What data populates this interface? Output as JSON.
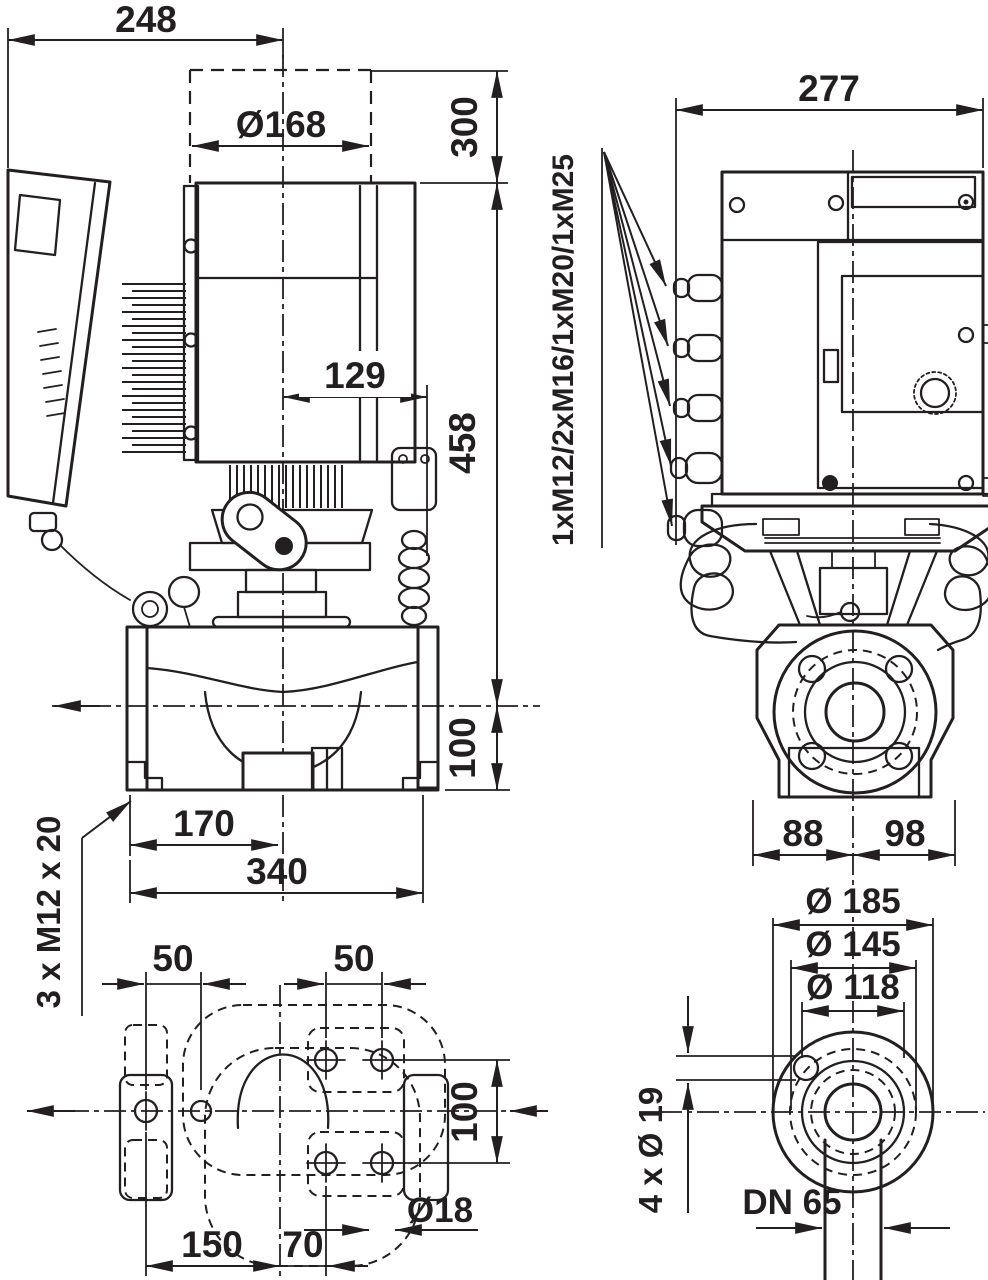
{
  "front_view": {
    "width_top": "248",
    "motor_diameter": "Ø168",
    "top_clearance": "300",
    "module_offset": "129",
    "height_above_axis": "458",
    "height_below_axis": "100",
    "port_to_center": "170",
    "port_to_port": "340",
    "foot_bolts": "3 x M12 x 20"
  },
  "side_view": {
    "width": "277",
    "cable_glands": "1xM12/2xM16/1xM20/1xM25",
    "center_to_left": "88",
    "center_to_right": "98"
  },
  "base_view": {
    "left_hole_spacing": "50",
    "right_hole_spacing": "50",
    "hole_row_spacing": "100",
    "hole_diameter": "Ø18",
    "center_to_left_holes": "150",
    "center_to_right_holes": "70"
  },
  "flange_view": {
    "outer_diameter": "Ø 185",
    "bolt_circle_diameter": "Ø 145",
    "raised_face_diameter": "Ø 118",
    "bolt_holes": "4 x Ø 19",
    "nominal_bore": "DN 65"
  }
}
